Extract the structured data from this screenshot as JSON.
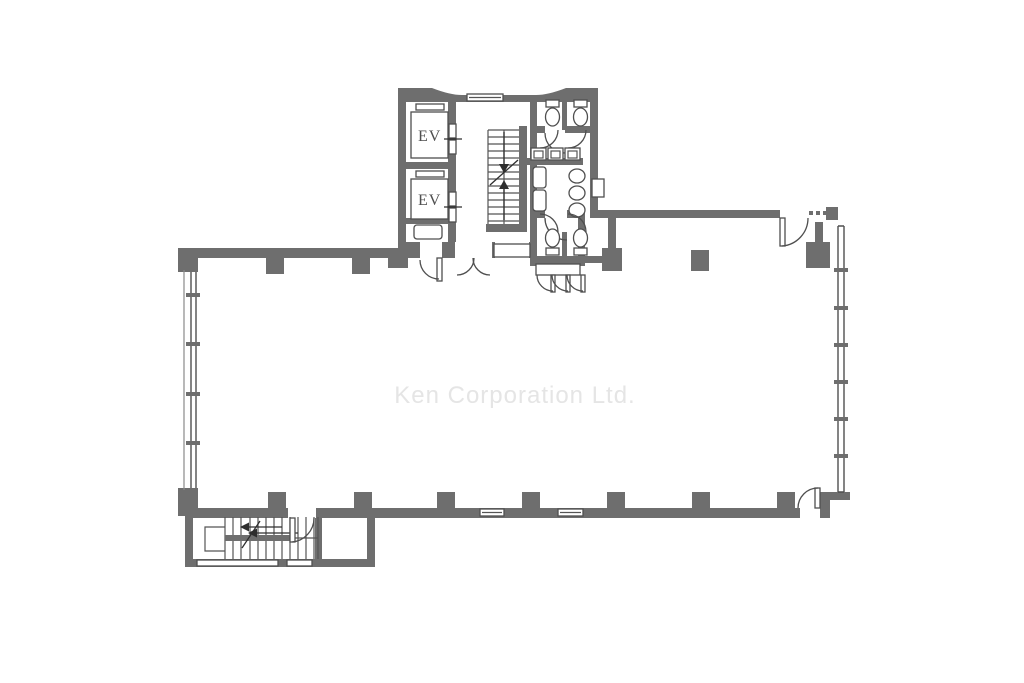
{
  "watermark": {
    "text": "Ken Corporation Ltd."
  },
  "labels": {
    "elevator_1": "EV",
    "elevator_2": "EV"
  },
  "colors": {
    "background": "#ffffff",
    "wall": "#6e6e6e",
    "line": "#4f4f4f",
    "ev_label": "#4f4f4f",
    "watermark_text": "#e5e5e5"
  }
}
